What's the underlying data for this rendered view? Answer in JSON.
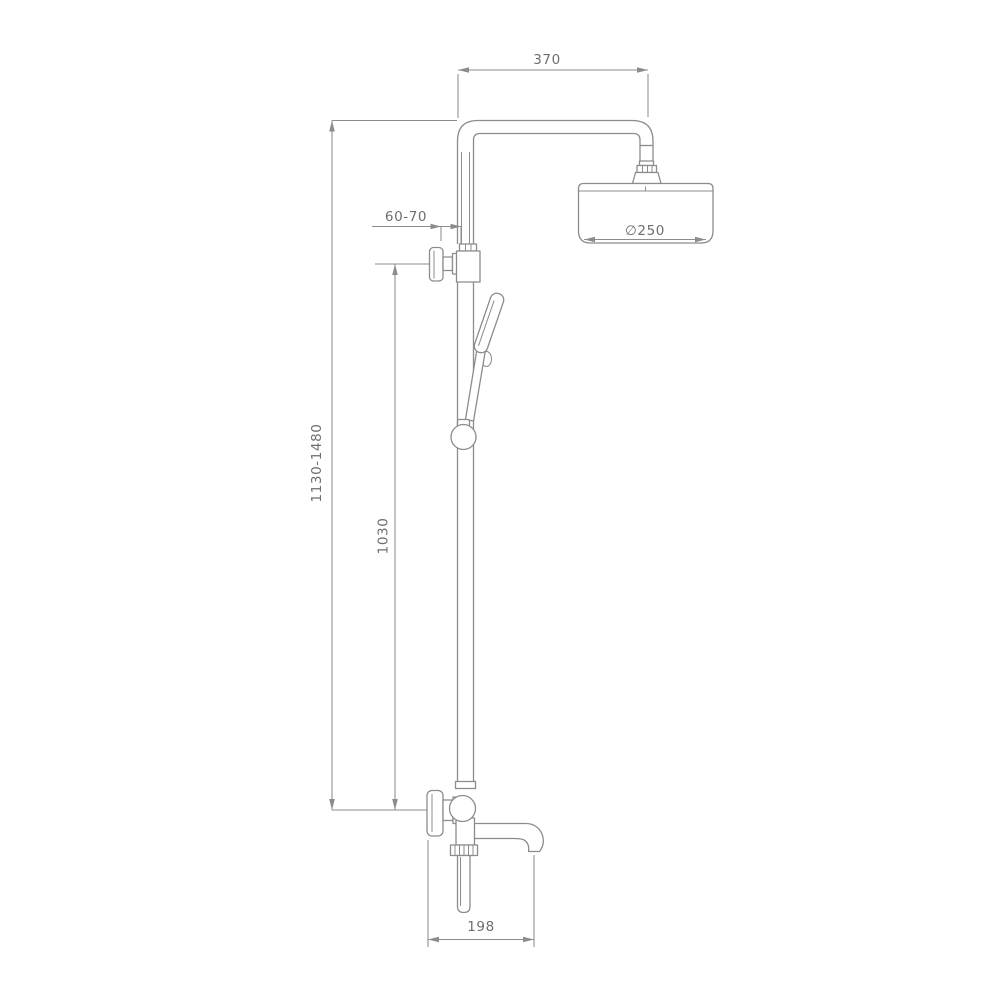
{
  "drawing": {
    "title": "shower system technical drawing",
    "colors": {
      "line": "#8c8c8c",
      "text": "#6e6e6e",
      "background": "#ffffff"
    },
    "dimensions": {
      "arm_length": "370",
      "wall_offset": "60-70",
      "overall_height_range": "1130-1480",
      "riser_height": "1030",
      "head_diameter": "∅250",
      "spout_length": "198"
    }
  }
}
